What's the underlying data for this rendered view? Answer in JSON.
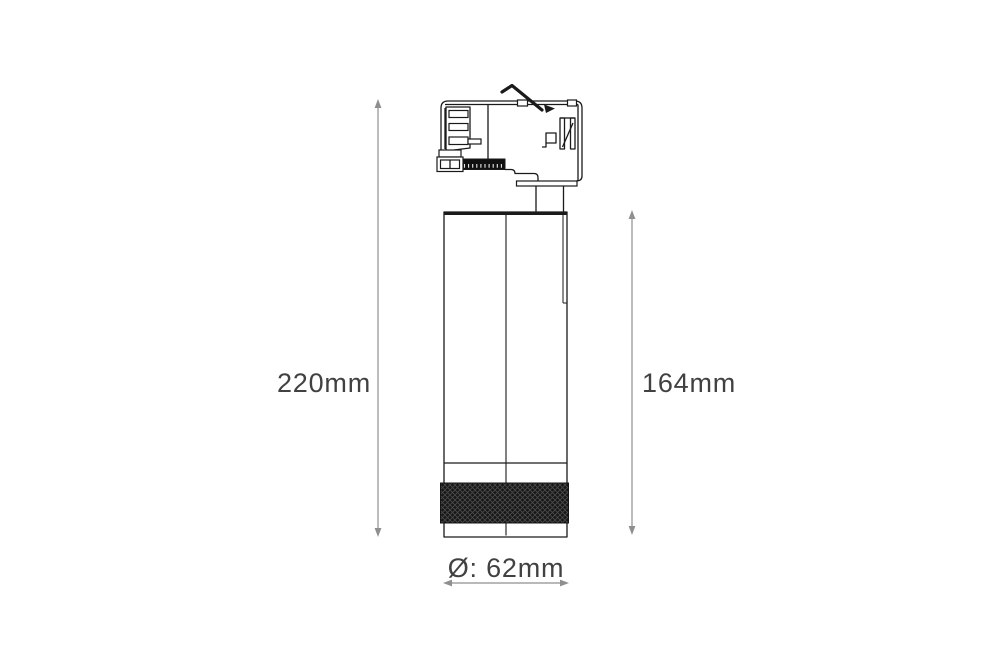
{
  "page": {
    "background": "#ffffff"
  },
  "diagram": {
    "type": "technical-dimension-drawing",
    "subject": "LED track-mounted spotlight, side elevation",
    "labels": {
      "overall_height": "220mm",
      "body_height": "164mm",
      "diameter": "Ø: 62mm"
    },
    "colors": {
      "outline": "#1a1a1a",
      "dimension_line": "#8f8f8f",
      "dimension_text": "#414141",
      "knurl_fill": "#161616",
      "background": "#ffffff"
    }
  }
}
